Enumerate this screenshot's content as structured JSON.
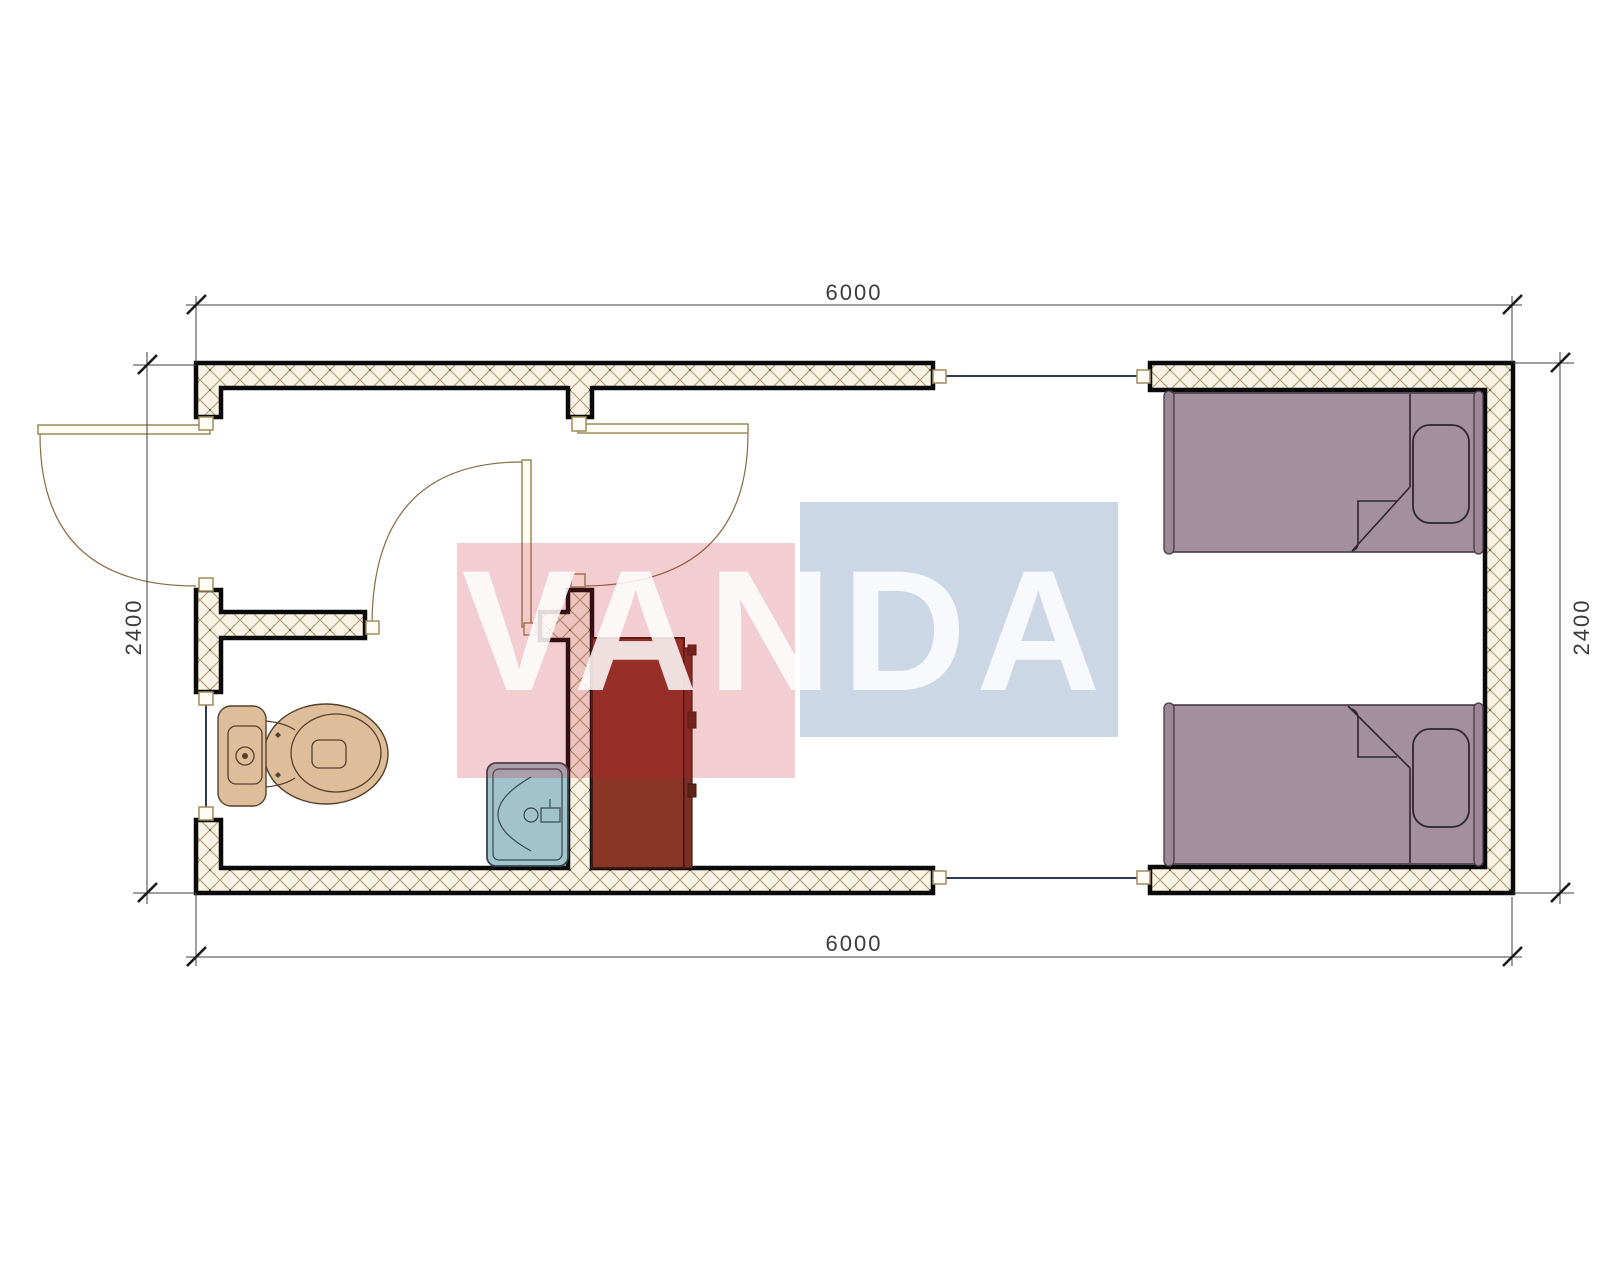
{
  "drawing": {
    "dimensions": {
      "top": "6000",
      "bottom": "6000",
      "left": "2400",
      "right": "2400"
    },
    "watermark": {
      "text": "VANDA",
      "red_color": "#c61c32",
      "blue_color": "#3a66a0"
    },
    "colors": {
      "wall_hatch_bg": "#f8f3e4",
      "wall_hatch_line": "#ab9c74",
      "wall_outline": "#0a0a0a",
      "window_glass": "#2b3a5c",
      "door_frame": "#9c8a55",
      "toilet": "#ddbd9a",
      "sink": "#a2c3cb",
      "cabinet": "#8a3526",
      "bed": "#a38f9e"
    },
    "fixtures": [
      "toilet",
      "sink",
      "cabinet",
      "single-bed",
      "single-bed"
    ]
  }
}
